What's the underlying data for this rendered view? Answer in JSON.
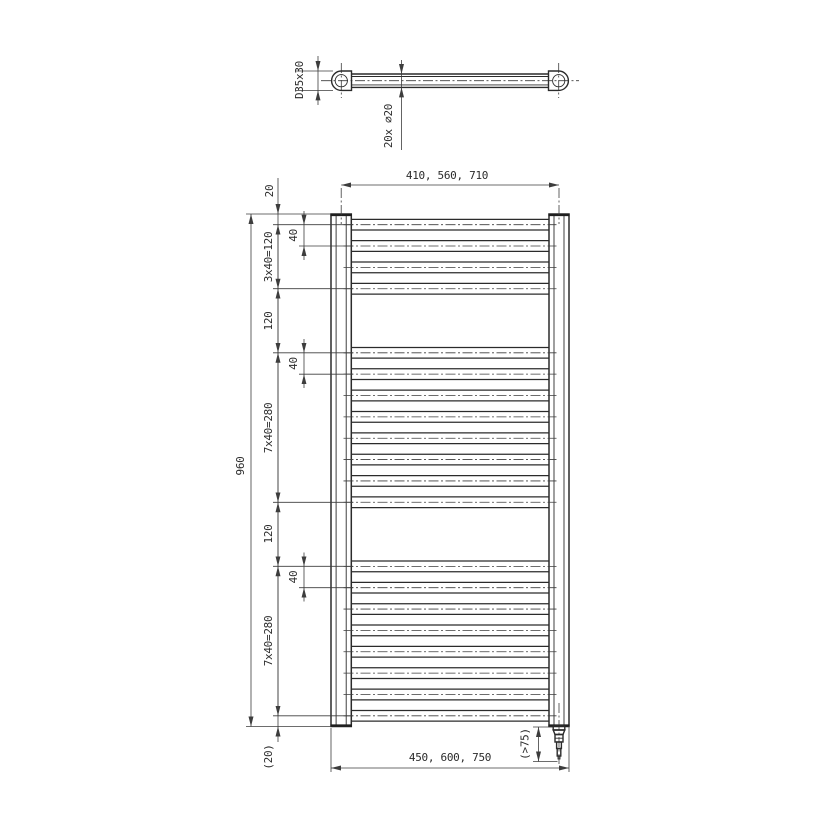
{
  "top_view": {
    "fitting_dim_label": "D35x30",
    "tube_dim_label": "20x ⌀20"
  },
  "front_view": {
    "dim_width_top": "410, 560, 710",
    "dim_width_bottom": "450, 600, 750",
    "dim_height_overall": "960",
    "dim_top_offset": "20",
    "dim_group_top": "3x40=120",
    "dim_gap_upper": "120",
    "dim_group_middle": "7x40=280",
    "dim_gap_lower": "120",
    "dim_group_bottom": "7x40=280",
    "dim_bottom_offset": "(20)",
    "dim_rung_pitch": "40",
    "dim_heater_clearance": "(>75)",
    "rungs": {
      "count": 20,
      "start_mm": 20,
      "pitch_mm": 40,
      "groups": [
        4,
        8,
        8
      ],
      "group_gap_mm": 120,
      "total_height_mm": 960
    }
  },
  "colors": {
    "line": "#2b2b2b",
    "dim": "#3d3d3d",
    "background": "#ffffff"
  }
}
